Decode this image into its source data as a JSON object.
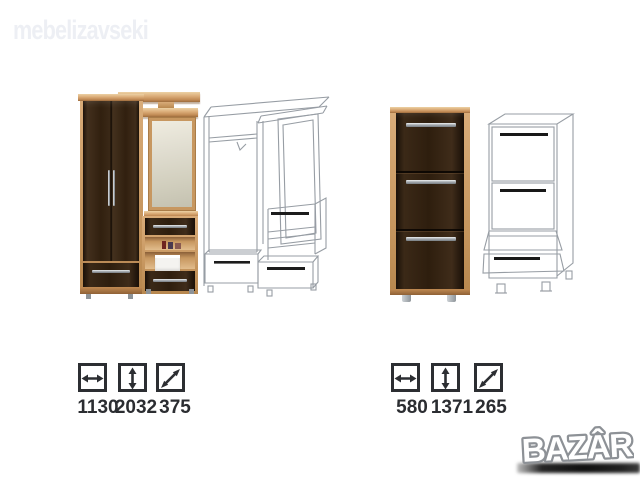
{
  "brand_watermark": {
    "text": "mebelizavseki"
  },
  "marketplace_watermark": {
    "text": "BAZÂR"
  },
  "products": {
    "hallway_unit": {
      "label": "hallway wardrobe with mirror",
      "dims": {
        "width": "1130",
        "height": "2032",
        "depth": "375"
      }
    },
    "shoe_cabinet": {
      "label": "shoe cabinet",
      "dims": {
        "width": "580",
        "height": "1371",
        "depth": "265"
      }
    }
  },
  "icons": {
    "width": "width-arrow-icon",
    "height": "height-arrow-icon",
    "depth": "depth-arrow-icon"
  },
  "colors": {
    "background": "#ffffff",
    "beech_wood": "#c79760",
    "wenge_wood": "#31200f",
    "schematic_line": "#979da4",
    "dimension_text": "#2b2d31",
    "brand_watermark": "#edeff4",
    "metal": "#a9aeb3",
    "bazar_fill": "#ffffff",
    "bazar_outline": "#8d9196",
    "bazar_shadow": "#101010"
  }
}
